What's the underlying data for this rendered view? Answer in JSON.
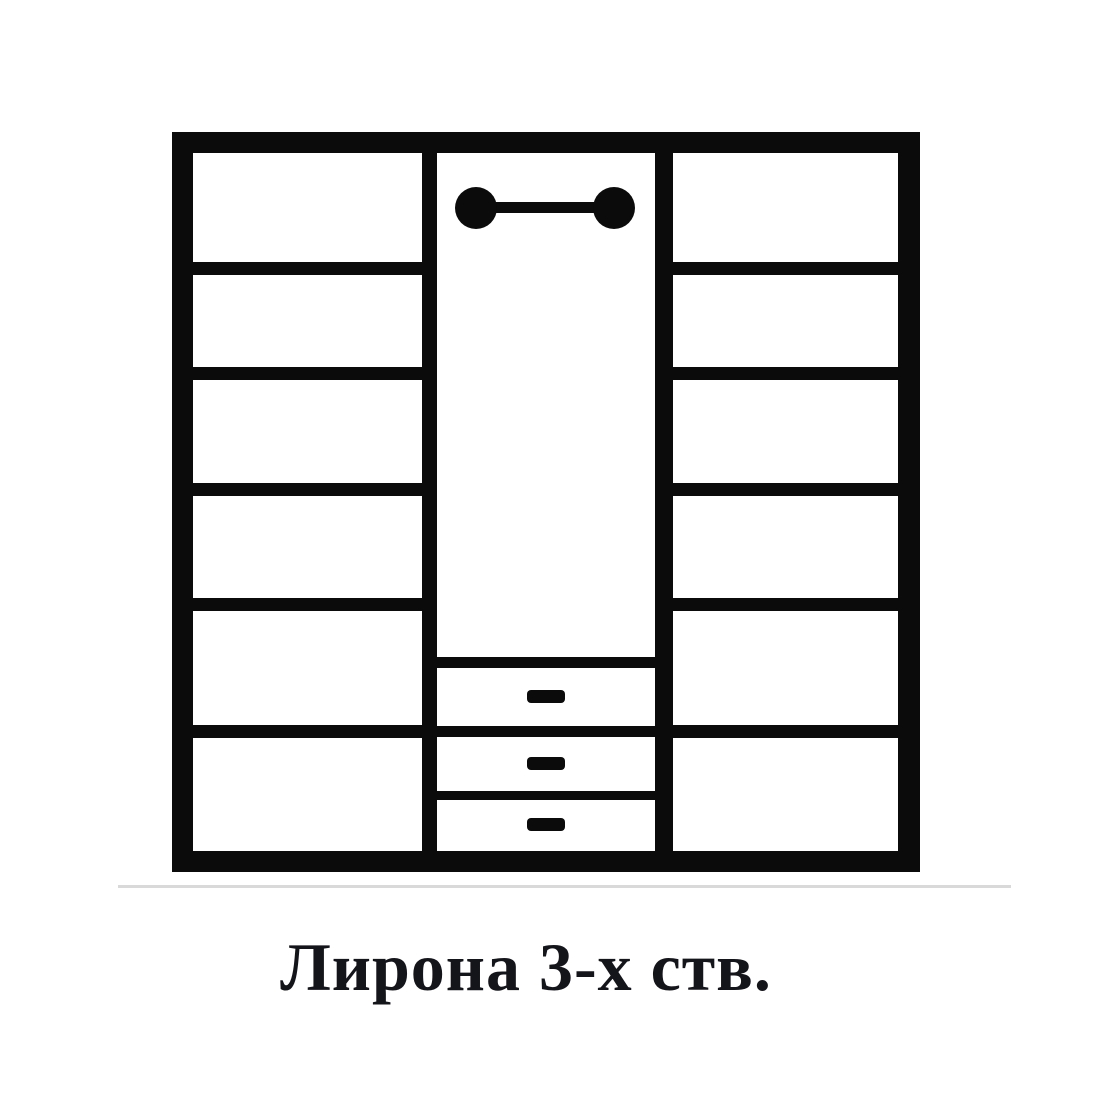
{
  "product": {
    "name": "Лирона 3-х ств."
  },
  "caption": {
    "text": "Лирона 3-х ств.",
    "color": "#14141b"
  },
  "sections": [
    {
      "position": "left",
      "type": "shelf-column",
      "shelves": 6
    },
    {
      "position": "middle",
      "type": "hanging-section",
      "has_hanging_rod": true,
      "drawers": 3
    },
    {
      "position": "right",
      "type": "shelf-column",
      "shelves": 6
    }
  ],
  "diagram": {
    "type": "wardrobe-front-schematic",
    "ink": "#0b0b0b",
    "paper": "#ffffff",
    "outer": {
      "x": 172,
      "y": 132,
      "w": 748,
      "h": 740
    },
    "inner": {
      "x": 193,
      "y": 153,
      "w": 705,
      "h": 698
    },
    "dividers": {
      "left": {
        "x": 422,
        "w": 15
      },
      "right": {
        "x": 655,
        "w": 18
      }
    },
    "left_col": {
      "x": 193,
      "w": 229
    },
    "right_col": {
      "x": 673,
      "w": 225
    },
    "shelf_lines_y": [
      262,
      367,
      483,
      598,
      725
    ],
    "shelf_thickness": 13,
    "middle": {
      "x": 437,
      "w": 218,
      "drawer_divider_y": [
        657,
        726,
        791
      ],
      "drawer_divider_h": [
        11,
        11,
        9
      ],
      "rod": {
        "cx1": 476,
        "cx2": 614,
        "cy": 208,
        "r": 21,
        "bar_y": 202,
        "bar_h": 11
      },
      "handle_x": 527,
      "handle_w": 38,
      "handle_h": 13,
      "handle_tops_y": [
        690,
        757,
        818
      ]
    },
    "shadow": {
      "x": 118,
      "y": 885,
      "w": 893,
      "h": 3,
      "color": "#d9d9d9"
    }
  }
}
